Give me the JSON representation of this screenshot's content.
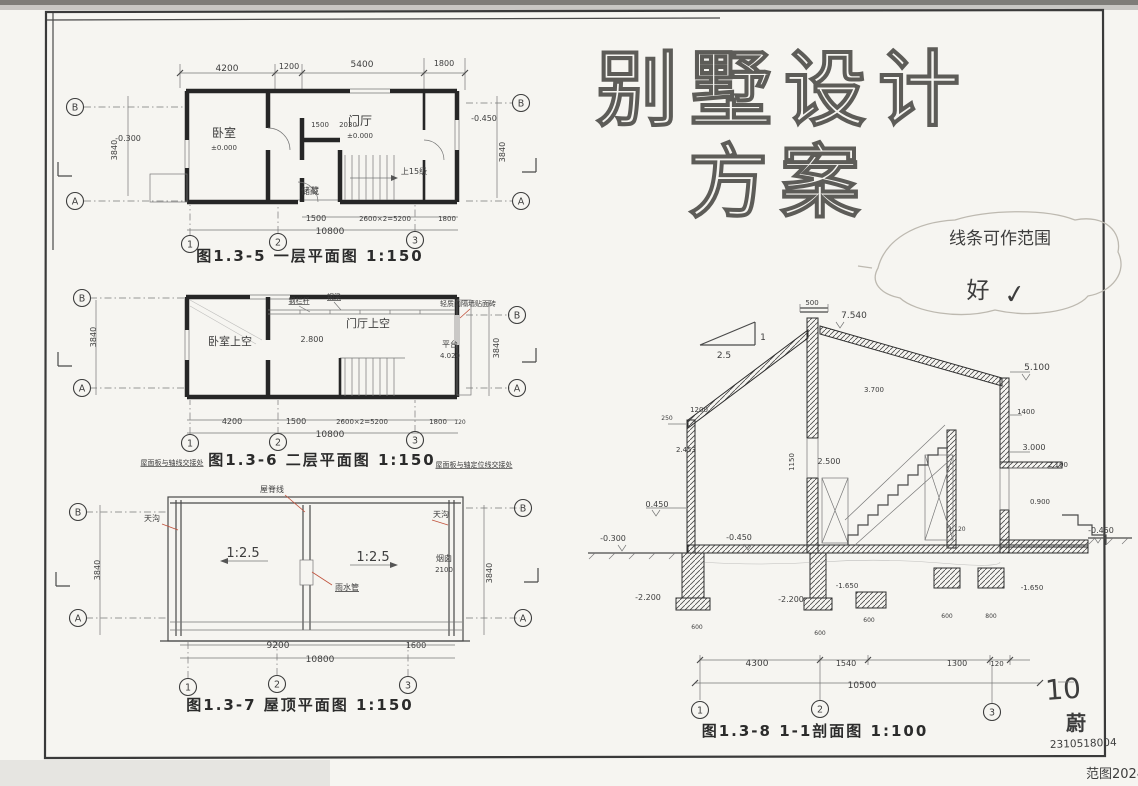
{
  "meta": {
    "page_number": "10",
    "author": "蔚",
    "student_id": "2310518004",
    "footer_red": "范图2024"
  },
  "title": {
    "line1": "别墅设计",
    "line2": "方案"
  },
  "teacher_note": {
    "text": "线条可作范围",
    "grade": "好",
    "check": "✓"
  },
  "figures": {
    "plan1": {
      "caption": "图1.3-5 一层平面图 1:150",
      "annotations": [
        {
          "t": "4200",
          "x": 227,
          "y": 71,
          "s": 9
        },
        {
          "t": "1200",
          "x": 289,
          "y": 69,
          "s": 8
        },
        {
          "t": "5400",
          "x": 362,
          "y": 67,
          "s": 9
        },
        {
          "t": "1800",
          "x": 444,
          "y": 66,
          "s": 8
        },
        {
          "t": "3840",
          "x": 117,
          "y": 150,
          "s": 8,
          "r": -90
        },
        {
          "t": "3840",
          "x": 505,
          "y": 152,
          "s": 8,
          "r": -90
        },
        {
          "t": "-0.300",
          "x": 128,
          "y": 141,
          "s": 8
        },
        {
          "t": "-0.450",
          "x": 484,
          "y": 121,
          "s": 8
        },
        {
          "t": "卧室",
          "x": 224,
          "y": 137,
          "s": 12
        },
        {
          "t": "±0.000",
          "x": 224,
          "y": 150,
          "s": 7
        },
        {
          "t": "门厅",
          "x": 360,
          "y": 125,
          "s": 12
        },
        {
          "t": "±0.000",
          "x": 360,
          "y": 138,
          "s": 7
        },
        {
          "t": "1500",
          "x": 320,
          "y": 127,
          "s": 7
        },
        {
          "t": "2030",
          "x": 348,
          "y": 127,
          "s": 7
        },
        {
          "t": "储藏",
          "x": 310,
          "y": 194,
          "s": 9
        },
        {
          "t": "上15级",
          "x": 414,
          "y": 174,
          "s": 8
        },
        {
          "t": "1500",
          "x": 316,
          "y": 221,
          "s": 8
        },
        {
          "t": "2600×2=5200",
          "x": 385,
          "y": 221,
          "s": 7
        },
        {
          "t": "1800",
          "x": 447,
          "y": 221,
          "s": 7
        },
        {
          "t": "10800",
          "x": 330,
          "y": 234,
          "s": 9
        }
      ],
      "bubbles": [
        {
          "t": "B",
          "x": 75,
          "y": 107
        },
        {
          "t": "A",
          "x": 75,
          "y": 201
        },
        {
          "t": "B",
          "x": 521,
          "y": 103
        },
        {
          "t": "A",
          "x": 521,
          "y": 201
        },
        {
          "t": "1",
          "x": 190,
          "y": 244
        },
        {
          "t": "2",
          "x": 278,
          "y": 242
        },
        {
          "t": "3",
          "x": 415,
          "y": 240
        }
      ]
    },
    "plan2": {
      "caption": "图1.3-6 二层平面图 1:150",
      "annotations": [
        {
          "t": "卧室上空",
          "x": 230,
          "y": 345,
          "s": 11
        },
        {
          "t": "门厅上空",
          "x": 368,
          "y": 327,
          "s": 11
        },
        {
          "t": "2.800",
          "x": 312,
          "y": 342,
          "s": 8
        },
        {
          "t": "钢栏杆",
          "x": 299,
          "y": 303,
          "s": 7,
          "u": true
        },
        {
          "t": "钢梁",
          "x": 334,
          "y": 299,
          "s": 7,
          "u": true
        },
        {
          "t": "轻质内隔墙贴面砖",
          "x": 468,
          "y": 306,
          "s": 7,
          "c": "#c0523c"
        },
        {
          "t": "平台",
          "x": 450,
          "y": 347,
          "s": 8
        },
        {
          "t": "4.020",
          "x": 450,
          "y": 358,
          "s": 7
        },
        {
          "t": "3840",
          "x": 96,
          "y": 337,
          "s": 8,
          "r": -90
        },
        {
          "t": "3840",
          "x": 499,
          "y": 348,
          "s": 8,
          "r": -90
        },
        {
          "t": "4200",
          "x": 232,
          "y": 424,
          "s": 8
        },
        {
          "t": "1500",
          "x": 296,
          "y": 424,
          "s": 8
        },
        {
          "t": "2600×2=5200",
          "x": 362,
          "y": 424,
          "s": 7
        },
        {
          "t": "1800",
          "x": 438,
          "y": 424,
          "s": 7
        },
        {
          "t": "120",
          "x": 460,
          "y": 424,
          "s": 6
        },
        {
          "t": "10800",
          "x": 330,
          "y": 437,
          "s": 9
        },
        {
          "t": "屋面板与轴线交接处",
          "x": 172,
          "y": 465,
          "s": 7,
          "c": "#c0523c",
          "u": true
        },
        {
          "t": "屋面板与轴定位线交接处",
          "x": 474,
          "y": 467,
          "s": 7,
          "c": "#c0523c",
          "u": true
        }
      ],
      "bubbles": [
        {
          "t": "B",
          "x": 82,
          "y": 298
        },
        {
          "t": "A",
          "x": 82,
          "y": 388
        },
        {
          "t": "B",
          "x": 517,
          "y": 315
        },
        {
          "t": "A",
          "x": 517,
          "y": 388
        },
        {
          "t": "1",
          "x": 190,
          "y": 443
        },
        {
          "t": "2",
          "x": 278,
          "y": 442
        },
        {
          "t": "3",
          "x": 415,
          "y": 440
        }
      ]
    },
    "plan3": {
      "caption": "图1.3-7 屋顶平面图 1:150",
      "annotations": [
        {
          "t": "1:2.5",
          "x": 243,
          "y": 557,
          "s": 13
        },
        {
          "t": "1:2.5",
          "x": 373,
          "y": 561,
          "s": 13
        },
        {
          "t": "屋脊线",
          "x": 272,
          "y": 492,
          "s": 8,
          "c": "#c0523c"
        },
        {
          "t": "天沟",
          "x": 152,
          "y": 521,
          "s": 8,
          "c": "#c0523c"
        },
        {
          "t": "天沟",
          "x": 441,
          "y": 517,
          "s": 8,
          "c": "#c0523c"
        },
        {
          "t": "雨水管",
          "x": 347,
          "y": 590,
          "s": 8,
          "c": "#c0523c",
          "u": true
        },
        {
          "t": "烟囱",
          "x": 444,
          "y": 561,
          "s": 8
        },
        {
          "t": "2100",
          "x": 444,
          "y": 572,
          "s": 7
        },
        {
          "t": "3840",
          "x": 100,
          "y": 570,
          "s": 8,
          "r": -90
        },
        {
          "t": "3840",
          "x": 492,
          "y": 573,
          "s": 8,
          "r": -90
        },
        {
          "t": "9200",
          "x": 278,
          "y": 648,
          "s": 9
        },
        {
          "t": "1600",
          "x": 416,
          "y": 648,
          "s": 8
        },
        {
          "t": "10800",
          "x": 320,
          "y": 662,
          "s": 9
        }
      ],
      "bubbles": [
        {
          "t": "B",
          "x": 78,
          "y": 512
        },
        {
          "t": "A",
          "x": 78,
          "y": 618
        },
        {
          "t": "B",
          "x": 523,
          "y": 508
        },
        {
          "t": "A",
          "x": 523,
          "y": 618
        },
        {
          "t": "1",
          "x": 188,
          "y": 687
        },
        {
          "t": "2",
          "x": 277,
          "y": 684
        },
        {
          "t": "3",
          "x": 408,
          "y": 685
        }
      ]
    },
    "section": {
      "caption": "图1.3-8 1-1剖面图 1:100",
      "annotations": [
        {
          "t": "1",
          "x": 763,
          "y": 340,
          "s": 9
        },
        {
          "t": "2.5",
          "x": 724,
          "y": 358,
          "s": 9
        },
        {
          "t": "500",
          "x": 812,
          "y": 305,
          "s": 7
        },
        {
          "t": "7.540",
          "x": 854,
          "y": 318,
          "s": 9
        },
        {
          "t": "3.700",
          "x": 874,
          "y": 392,
          "s": 7
        },
        {
          "t": "2.500",
          "x": 829,
          "y": 464,
          "s": 8
        },
        {
          "t": "1150",
          "x": 794,
          "y": 462,
          "s": 7,
          "r": -90
        },
        {
          "t": "5.100",
          "x": 1037,
          "y": 370,
          "s": 9
        },
        {
          "t": "1400",
          "x": 1026,
          "y": 414,
          "s": 7
        },
        {
          "t": "3.000",
          "x": 1034,
          "y": 450,
          "s": 8
        },
        {
          "t": "2.100",
          "x": 1058,
          "y": 467,
          "s": 7
        },
        {
          "t": "0.900",
          "x": 1040,
          "y": 504,
          "s": 7
        },
        {
          "t": "1.120",
          "x": 957,
          "y": 531,
          "s": 6
        },
        {
          "t": "250",
          "x": 667,
          "y": 420,
          "s": 6
        },
        {
          "t": "1200",
          "x": 699,
          "y": 412,
          "s": 7
        },
        {
          "t": "2.453",
          "x": 686,
          "y": 452,
          "s": 7
        },
        {
          "t": "0.450",
          "x": 657,
          "y": 507,
          "s": 8
        },
        {
          "t": "-0.300",
          "x": 613,
          "y": 541,
          "s": 8
        },
        {
          "t": "-0.450",
          "x": 739,
          "y": 540,
          "s": 8
        },
        {
          "t": "-0.450",
          "x": 1101,
          "y": 533,
          "s": 8
        },
        {
          "t": "-2.200",
          "x": 648,
          "y": 600,
          "s": 8
        },
        {
          "t": "-2.200",
          "x": 791,
          "y": 602,
          "s": 8
        },
        {
          "t": "-1.650",
          "x": 847,
          "y": 588,
          "s": 7
        },
        {
          "t": "-1.650",
          "x": 1032,
          "y": 590,
          "s": 7
        },
        {
          "t": "600",
          "x": 697,
          "y": 629,
          "s": 6
        },
        {
          "t": "600",
          "x": 820,
          "y": 635,
          "s": 6
        },
        {
          "t": "600",
          "x": 869,
          "y": 622,
          "s": 6
        },
        {
          "t": "600",
          "x": 947,
          "y": 618,
          "s": 6
        },
        {
          "t": "800",
          "x": 991,
          "y": 618,
          "s": 6
        },
        {
          "t": "4300",
          "x": 757,
          "y": 666,
          "s": 9
        },
        {
          "t": "1540",
          "x": 846,
          "y": 666,
          "s": 8
        },
        {
          "t": "1300",
          "x": 957,
          "y": 666,
          "s": 8
        },
        {
          "t": "120",
          "x": 997,
          "y": 666,
          "s": 7
        },
        {
          "t": "10500",
          "x": 862,
          "y": 688,
          "s": 9
        }
      ],
      "bubbles": [
        {
          "t": "1",
          "x": 700,
          "y": 710
        },
        {
          "t": "2",
          "x": 820,
          "y": 709
        },
        {
          "t": "3",
          "x": 992,
          "y": 712
        }
      ]
    }
  }
}
